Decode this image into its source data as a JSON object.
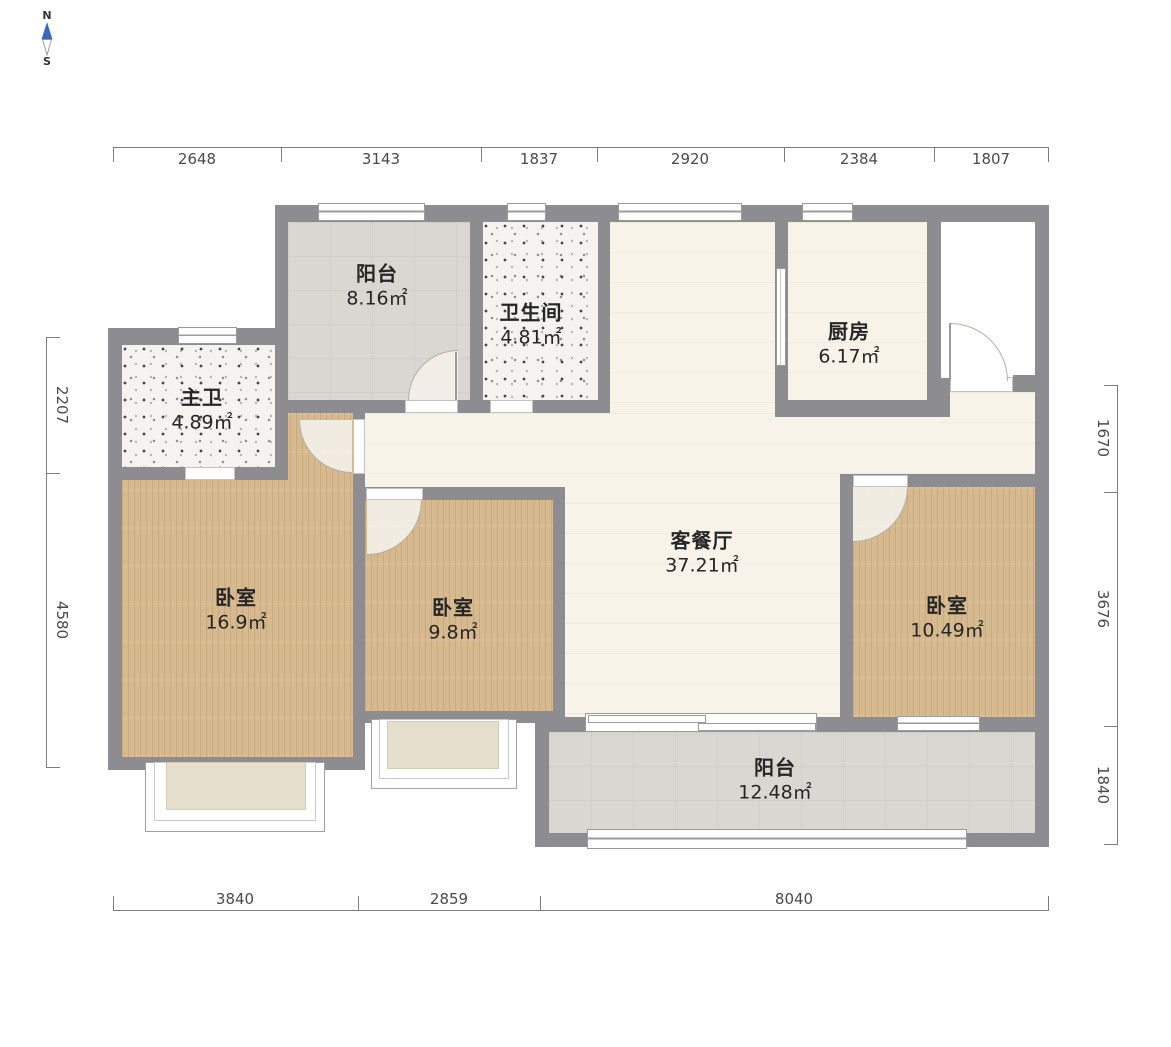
{
  "compass": {
    "north": "N",
    "south": "S"
  },
  "dimensions": {
    "top": [
      "2648",
      "3143",
      "1837",
      "2920",
      "2384",
      "1807"
    ],
    "bottom": [
      "3840",
      "2859",
      "8040"
    ],
    "left": [
      "2207",
      "4580"
    ],
    "right": [
      "1670",
      "3676",
      "1840"
    ]
  },
  "rooms": [
    {
      "name": "阳台",
      "area": "8.16㎡"
    },
    {
      "name": "卫生间",
      "area": "4.81㎡"
    },
    {
      "name": "厨房",
      "area": "6.17㎡"
    },
    {
      "name": "主卫",
      "area": "4.89㎡"
    },
    {
      "name": "卧室",
      "area": "16.9㎡"
    },
    {
      "name": "卧室",
      "area": "9.8㎡"
    },
    {
      "name": "客餐厅",
      "area": "37.21㎡"
    },
    {
      "name": "卧室",
      "area": "10.49㎡"
    },
    {
      "name": "阳台",
      "area": "12.48㎡"
    }
  ],
  "colors": {
    "wall": "#8c8c91",
    "wood_floor": "#d6b98f",
    "grey_tile": "#d9d7d2",
    "cream_floor": "#f7f3e9",
    "terrazzo": "#f4f3ef",
    "bay_fill": "#e6dfcd",
    "compass_needle": "#3a67b8",
    "dimension_text": "#4a4a4a"
  }
}
